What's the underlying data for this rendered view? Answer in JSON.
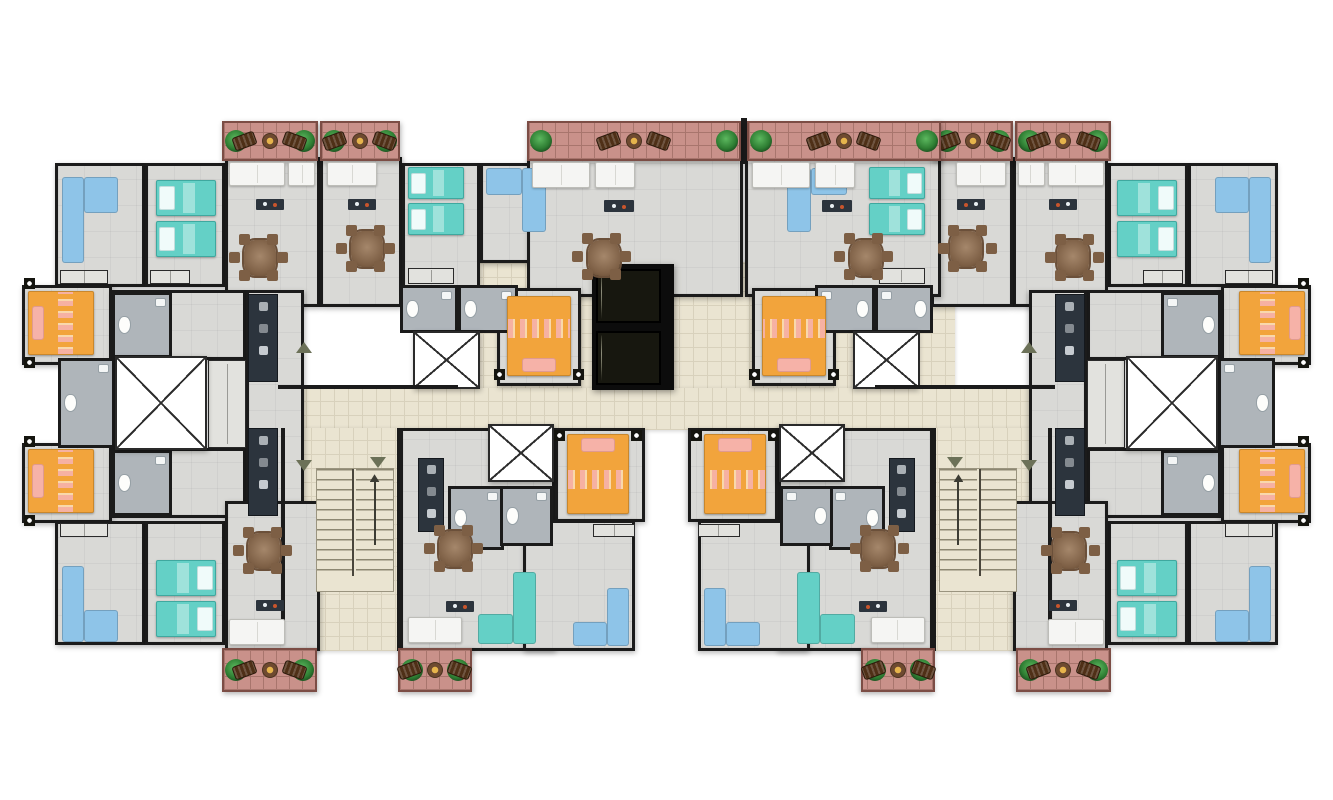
{
  "meta": {
    "title": "Residential tower - typical floor plan",
    "type": "architectural-floor-plan",
    "canvas": {
      "w": 1333,
      "h": 800
    },
    "background": "#ffffff",
    "symmetry": "left-right mirrored wings",
    "apartments_visible": 10
  },
  "palette": {
    "wall": "#1b1b1b",
    "roomfloor": "#d9d9d6",
    "bathfloor": "#afb5ba",
    "tile": "#eae4d1",
    "tileline": "#d8d1bc",
    "brick": "#c9918a",
    "brickline": "#a8756d",
    "orange": "#f2a43c",
    "pink": "#f6b2a8",
    "teal": "#64d0c6",
    "blue": "#8ec4e8",
    "wood": "#7d5f45",
    "dark": "#2c343d",
    "steel": "#aab0b5",
    "plantgreen": "#2e7d32",
    "sofawhite": "#f5f5f3"
  },
  "legend": {
    "orange-furniture": "double bed (master bedroom)",
    "teal-furniture": "single beds and loveseats",
    "blue-furniture": "corner sofas",
    "white-x-square": "service shaft / stair core",
    "dark-shaft": "elevator shaft with two cars",
    "beige-floor": "shared corridor and stair halls",
    "brick-floor": "balconies with planters, lounge chairs and tables",
    "gray-floor": "apartment interiors",
    "blue-gray-floor": "bathrooms with toilet and sink"
  },
  "scene": {
    "items": [
      {
        "n": "corridor-elevator-lobby",
        "t": "floor",
        "x": 455,
        "y": 262,
        "w": 500,
        "h": 128
      },
      {
        "n": "corridor-main",
        "t": "floor",
        "x": 278,
        "y": 388,
        "w": 777,
        "h": 42
      },
      {
        "n": "stair-lobby",
        "t": "floor",
        "x": 283,
        "y": 428,
        "w": 118,
        "h": 223,
        "m": 1
      },
      {
        "n": "bedroom-nw-blue",
        "t": "room",
        "x": 55,
        "y": 163,
        "w": 90,
        "h": 124,
        "m": 1
      },
      {
        "n": "bedroom-nw-teal",
        "t": "room",
        "x": 145,
        "y": 163,
        "w": 80,
        "h": 124,
        "m": 1
      },
      {
        "n": "living-nw-a",
        "t": "room",
        "x": 225,
        "y": 157,
        "w": 95,
        "h": 150,
        "m": 1
      },
      {
        "n": "living-nw-b",
        "t": "room",
        "x": 320,
        "y": 157,
        "w": 82,
        "h": 150,
        "m": 1
      },
      {
        "n": "bedroom-n-teal",
        "t": "room",
        "x": 402,
        "y": 163,
        "w": 78,
        "h": 128,
        "m": 1
      },
      {
        "n": "bedroom-n-blue",
        "t": "room",
        "x": 480,
        "y": 163,
        "w": 82,
        "h": 100,
        "m": 1
      },
      {
        "n": "living-nc-a",
        "t": "room",
        "x": 527,
        "y": 157,
        "w": 216,
        "h": 140
      },
      {
        "n": "living-nc-b",
        "t": "room",
        "x": 745,
        "y": 157,
        "w": 196,
        "h": 140
      },
      {
        "n": "master-w-up",
        "t": "room",
        "x": 22,
        "y": 285,
        "w": 90,
        "h": 80,
        "m": 1
      },
      {
        "n": "hall-w-up",
        "t": "room",
        "x": 110,
        "y": 290,
        "w": 136,
        "h": 70,
        "m": 1
      },
      {
        "n": "master-w-dn",
        "t": "room",
        "x": 22,
        "y": 443,
        "w": 90,
        "h": 80,
        "m": 1
      },
      {
        "n": "hall-w-dn",
        "t": "room",
        "x": 110,
        "y": 448,
        "w": 136,
        "h": 70,
        "m": 1
      },
      {
        "n": "kitchen-zone-w",
        "t": "room",
        "x": 246,
        "y": 290,
        "w": 58,
        "h": 228,
        "m": 1
      },
      {
        "n": "bedroom-sw-blue",
        "t": "room",
        "x": 55,
        "y": 521,
        "w": 90,
        "h": 124,
        "m": 1
      },
      {
        "n": "bedroom-sw-teal",
        "t": "room",
        "x": 145,
        "y": 521,
        "w": 80,
        "h": 124,
        "m": 1
      },
      {
        "n": "living-sw",
        "t": "room",
        "x": 225,
        "y": 501,
        "w": 95,
        "h": 150,
        "m": 1
      },
      {
        "n": "living-s-mid",
        "t": "room",
        "x": 400,
        "y": 428,
        "w": 155,
        "h": 223,
        "m": 1
      },
      {
        "n": "bedroom-s-orange",
        "t": "room",
        "x": 555,
        "y": 428,
        "w": 90,
        "h": 94,
        "m": 1
      },
      {
        "n": "living-s-center",
        "t": "room",
        "x": 523,
        "y": 520,
        "w": 112,
        "h": 131,
        "m": 1
      },
      {
        "n": "master-nc-orange",
        "t": "room",
        "x": 497,
        "y": 288,
        "w": 84,
        "h": 98,
        "m": 1
      },
      {
        "n": "bath-w-mid",
        "t": "bath",
        "x": 58,
        "y": 358,
        "w": 57,
        "h": 90,
        "m": 1
      },
      {
        "n": "bath-w-up",
        "t": "bath",
        "x": 112,
        "y": 292,
        "w": 60,
        "h": 66,
        "m": 1
      },
      {
        "n": "bath-w-dn",
        "t": "bath",
        "x": 112,
        "y": 450,
        "w": 60,
        "h": 66,
        "m": 1
      },
      {
        "n": "bath-n-mid-a",
        "t": "bath",
        "x": 400,
        "y": 285,
        "w": 58,
        "h": 48,
        "m": 1
      },
      {
        "n": "bath-n-mid-b",
        "t": "bath",
        "x": 458,
        "y": 285,
        "w": 60,
        "h": 48,
        "m": 1
      },
      {
        "n": "bath-s-mid",
        "t": "bath",
        "x": 448,
        "y": 486,
        "w": 56,
        "h": 64,
        "m": 1
      },
      {
        "n": "bath-s-center",
        "t": "bath",
        "x": 500,
        "y": 486,
        "w": 53,
        "h": 60,
        "m": 1
      },
      {
        "n": "kitchen-w-up",
        "t": "kitch",
        "x": 248,
        "y": 294,
        "w": 30,
        "h": 88,
        "m": 1
      },
      {
        "n": "kitchen-w-dn",
        "t": "kitch",
        "x": 248,
        "y": 428,
        "w": 30,
        "h": 88,
        "m": 1
      },
      {
        "n": "kitchen-s-mid",
        "t": "kitch",
        "x": 418,
        "y": 458,
        "w": 26,
        "h": 74,
        "m": 1
      },
      {
        "n": "laundry-w-mid",
        "t": "cab",
        "x": 208,
        "y": 360,
        "w": 38,
        "h": 88,
        "m": 1
      },
      {
        "n": "closet-nw-a",
        "t": "cab",
        "x": 60,
        "y": 270,
        "w": 48,
        "h": 14,
        "m": 1
      },
      {
        "n": "closet-nw-b",
        "t": "cab",
        "x": 150,
        "y": 270,
        "w": 40,
        "h": 14,
        "m": 1
      },
      {
        "n": "closet-n-teal",
        "t": "cab",
        "x": 408,
        "y": 268,
        "w": 46,
        "h": 16,
        "m": 1
      },
      {
        "n": "closet-sw-a",
        "t": "cab",
        "x": 60,
        "y": 523,
        "w": 48,
        "h": 14,
        "m": 1
      },
      {
        "n": "closet-s-center",
        "t": "cab",
        "x": 593,
        "y": 524,
        "w": 42,
        "h": 13,
        "m": 1
      },
      {
        "n": "stair-core-w",
        "t": "xbox",
        "x": 115,
        "y": 356,
        "w": 92,
        "h": 94,
        "m": 1
      },
      {
        "n": "shaft-n-small",
        "t": "xbox",
        "x": 413,
        "y": 331,
        "w": 67,
        "h": 58,
        "m": 1
      },
      {
        "n": "shaft-s-small",
        "t": "xbox",
        "x": 488,
        "y": 424,
        "w": 66,
        "h": 58,
        "m": 1
      },
      {
        "n": "elevator-shaft",
        "t": "elev",
        "x": 592,
        "y": 264,
        "w": 82,
        "h": 126
      },
      {
        "n": "stairs-w",
        "t": "stairs",
        "x": 316,
        "y": 468,
        "w": 78,
        "h": 124,
        "m": 1
      },
      {
        "n": "wall-balcony-divider",
        "t": "wall",
        "x": 741,
        "y": 118,
        "w": 6,
        "h": 46
      },
      {
        "n": "wall-stair-lobby-w",
        "t": "wall",
        "x": 281,
        "y": 428,
        "w": 4,
        "h": 200,
        "m": 1
      },
      {
        "n": "wall-stair-lobby-e",
        "t": "wall",
        "x": 397,
        "y": 428,
        "w": 4,
        "h": 223,
        "m": 1
      },
      {
        "n": "wall-corridor-top",
        "t": "wall",
        "x": 278,
        "y": 385,
        "w": 180,
        "h": 4,
        "m": 1
      },
      {
        "n": "balcony-nw-a",
        "t": "balc",
        "x": 222,
        "y": 121,
        "w": 96,
        "h": 40,
        "m": 1
      },
      {
        "n": "balcony-nw-b",
        "t": "balc",
        "x": 320,
        "y": 121,
        "w": 80,
        "h": 40,
        "m": 1
      },
      {
        "n": "balcony-nc-a",
        "t": "balc",
        "x": 527,
        "y": 121,
        "w": 214,
        "h": 40
      },
      {
        "n": "balcony-nc-b",
        "t": "balc",
        "x": 747,
        "y": 121,
        "w": 194,
        "h": 40
      },
      {
        "n": "balcony-sw-a",
        "t": "balc",
        "x": 222,
        "y": 648,
        "w": 95,
        "h": 44,
        "m": 1
      },
      {
        "n": "balcony-sw-b",
        "t": "balc",
        "x": 398,
        "y": 648,
        "w": 74,
        "h": 44,
        "m": 1
      },
      {
        "n": "bed-master-w-up",
        "t": "bedo",
        "x": 28,
        "y": 291,
        "w": 66,
        "h": 64,
        "d": "w",
        "m": 1
      },
      {
        "n": "bed-master-w-dn",
        "t": "bedo",
        "x": 28,
        "y": 449,
        "w": 66,
        "h": 64,
        "d": "w",
        "m": 1
      },
      {
        "n": "bed-master-nc",
        "t": "bedo",
        "x": 507,
        "y": 296,
        "w": 64,
        "h": 80,
        "d": "s",
        "m": 1
      },
      {
        "n": "bed-s-center",
        "t": "bedo",
        "x": 567,
        "y": 434,
        "w": 62,
        "h": 80,
        "d": "n",
        "m": 1
      },
      {
        "n": "bed-nw-teal-a",
        "t": "bedt",
        "x": 156,
        "y": 180,
        "w": 60,
        "h": 36,
        "d": "w",
        "m": 1
      },
      {
        "n": "bed-nw-teal-b",
        "t": "bedt",
        "x": 156,
        "y": 221,
        "w": 60,
        "h": 36,
        "d": "w",
        "m": 1
      },
      {
        "n": "bed-n-teal-a",
        "t": "bedt",
        "x": 408,
        "y": 167,
        "w": 56,
        "h": 32,
        "d": "w",
        "m": 1
      },
      {
        "n": "bed-n-teal-b",
        "t": "bedt",
        "x": 408,
        "y": 203,
        "w": 56,
        "h": 32,
        "d": "w",
        "m": 1
      },
      {
        "n": "bed-sw-teal-a",
        "t": "bedt",
        "x": 156,
        "y": 560,
        "w": 60,
        "h": 36,
        "d": "e",
        "m": 1
      },
      {
        "n": "bed-sw-teal-b",
        "t": "bedt",
        "x": 156,
        "y": 601,
        "w": 60,
        "h": 36,
        "d": "e",
        "m": 1
      },
      {
        "n": "sofa-nw-blue",
        "t": "sofaL",
        "x": 62,
        "y": 177,
        "w": 56,
        "h": 86,
        "o": "nw",
        "v": "blue",
        "m": 1
      },
      {
        "n": "sofa-n-blue",
        "t": "sofaL",
        "x": 486,
        "y": 168,
        "w": 60,
        "h": 64,
        "o": "ne",
        "v": "blue",
        "m": 1
      },
      {
        "n": "sofa-sw-blue",
        "t": "sofaL",
        "x": 62,
        "y": 566,
        "w": 56,
        "h": 76,
        "o": "sw",
        "v": "blue",
        "m": 1
      },
      {
        "n": "sofa-s-mid-teal",
        "t": "sofaL",
        "x": 478,
        "y": 572,
        "w": 58,
        "h": 72,
        "o": "se",
        "v": "teal",
        "m": 1
      },
      {
        "n": "sofa-s-center-blue",
        "t": "sofaL",
        "x": 573,
        "y": 588,
        "w": 56,
        "h": 58,
        "o": "se",
        "v": "blue",
        "m": 1
      },
      {
        "n": "sofa-living-nw-a",
        "t": "sofaw",
        "x": 229,
        "y": 162,
        "w": 56,
        "h": 24,
        "m": 1
      },
      {
        "n": "sofa-living-nw-a2",
        "t": "sofaw",
        "x": 288,
        "y": 162,
        "w": 27,
        "h": 24,
        "m": 1
      },
      {
        "n": "sofa-living-nw-b",
        "t": "sofaw",
        "x": 327,
        "y": 162,
        "w": 50,
        "h": 24,
        "m": 1
      },
      {
        "n": "sofa-living-nc-a",
        "t": "sofaw",
        "x": 532,
        "y": 162,
        "w": 58,
        "h": 26
      },
      {
        "n": "sofa-living-nc-a2",
        "t": "sofaw",
        "x": 595,
        "y": 162,
        "w": 40,
        "h": 26
      },
      {
        "n": "sofa-living-nc-b",
        "t": "sofaw",
        "x": 752,
        "y": 162,
        "w": 58,
        "h": 26
      },
      {
        "n": "sofa-living-nc-b2",
        "t": "sofaw",
        "x": 815,
        "y": 162,
        "w": 40,
        "h": 26
      },
      {
        "n": "sofa-living-sw",
        "t": "sofaw",
        "x": 229,
        "y": 619,
        "w": 56,
        "h": 26,
        "m": 1
      },
      {
        "n": "sofa-living-s-mid",
        "t": "sofaw",
        "x": 408,
        "y": 617,
        "w": 54,
        "h": 26,
        "m": 1
      },
      {
        "n": "tv-desk-nw-a",
        "t": "desk",
        "x": 256,
        "y": 199,
        "w": 28,
        "h": 11,
        "m": 1
      },
      {
        "n": "tv-desk-nw-b",
        "t": "desk",
        "x": 348,
        "y": 199,
        "w": 28,
        "h": 11,
        "m": 1
      },
      {
        "n": "tv-desk-nc-a",
        "t": "desk",
        "x": 604,
        "y": 200,
        "w": 30,
        "h": 12
      },
      {
        "n": "tv-desk-nc-b",
        "t": "desk",
        "x": 822,
        "y": 200,
        "w": 30,
        "h": 12
      },
      {
        "n": "tv-desk-sw",
        "t": "desk",
        "x": 256,
        "y": 600,
        "w": 28,
        "h": 11,
        "m": 1
      },
      {
        "n": "tv-desk-s-mid",
        "t": "desk",
        "x": 446,
        "y": 601,
        "w": 28,
        "h": 11,
        "m": 1
      },
      {
        "n": "dining-nw-a",
        "t": "dining",
        "x": 233,
        "y": 231,
        "w": 54,
        "h": 54,
        "m": 1
      },
      {
        "n": "dining-nw-b",
        "t": "dining",
        "x": 340,
        "y": 222,
        "w": 54,
        "h": 54,
        "m": 1
      },
      {
        "n": "dining-nc-a",
        "t": "dining",
        "x": 576,
        "y": 230,
        "w": 56,
        "h": 56
      },
      {
        "n": "dining-nc-b",
        "t": "dining",
        "x": 838,
        "y": 230,
        "w": 56,
        "h": 56
      },
      {
        "n": "dining-sw",
        "t": "dining",
        "x": 237,
        "y": 524,
        "w": 54,
        "h": 54,
        "m": 1
      },
      {
        "n": "dining-s-mid",
        "t": "dining",
        "x": 428,
        "y": 522,
        "w": 54,
        "h": 54,
        "m": 1
      },
      {
        "n": "arrow-corridor-up",
        "t": "triu",
        "x": 296,
        "y": 342,
        "w": 16,
        "h": 11,
        "m": 1
      },
      {
        "n": "arrow-corridor-down",
        "t": "tri",
        "x": 296,
        "y": 460,
        "w": 16,
        "h": 11,
        "m": 1
      },
      {
        "n": "arrow-stair-hall",
        "t": "tri",
        "x": 370,
        "y": 457,
        "w": 16,
        "h": 11,
        "m": 1
      }
    ]
  }
}
